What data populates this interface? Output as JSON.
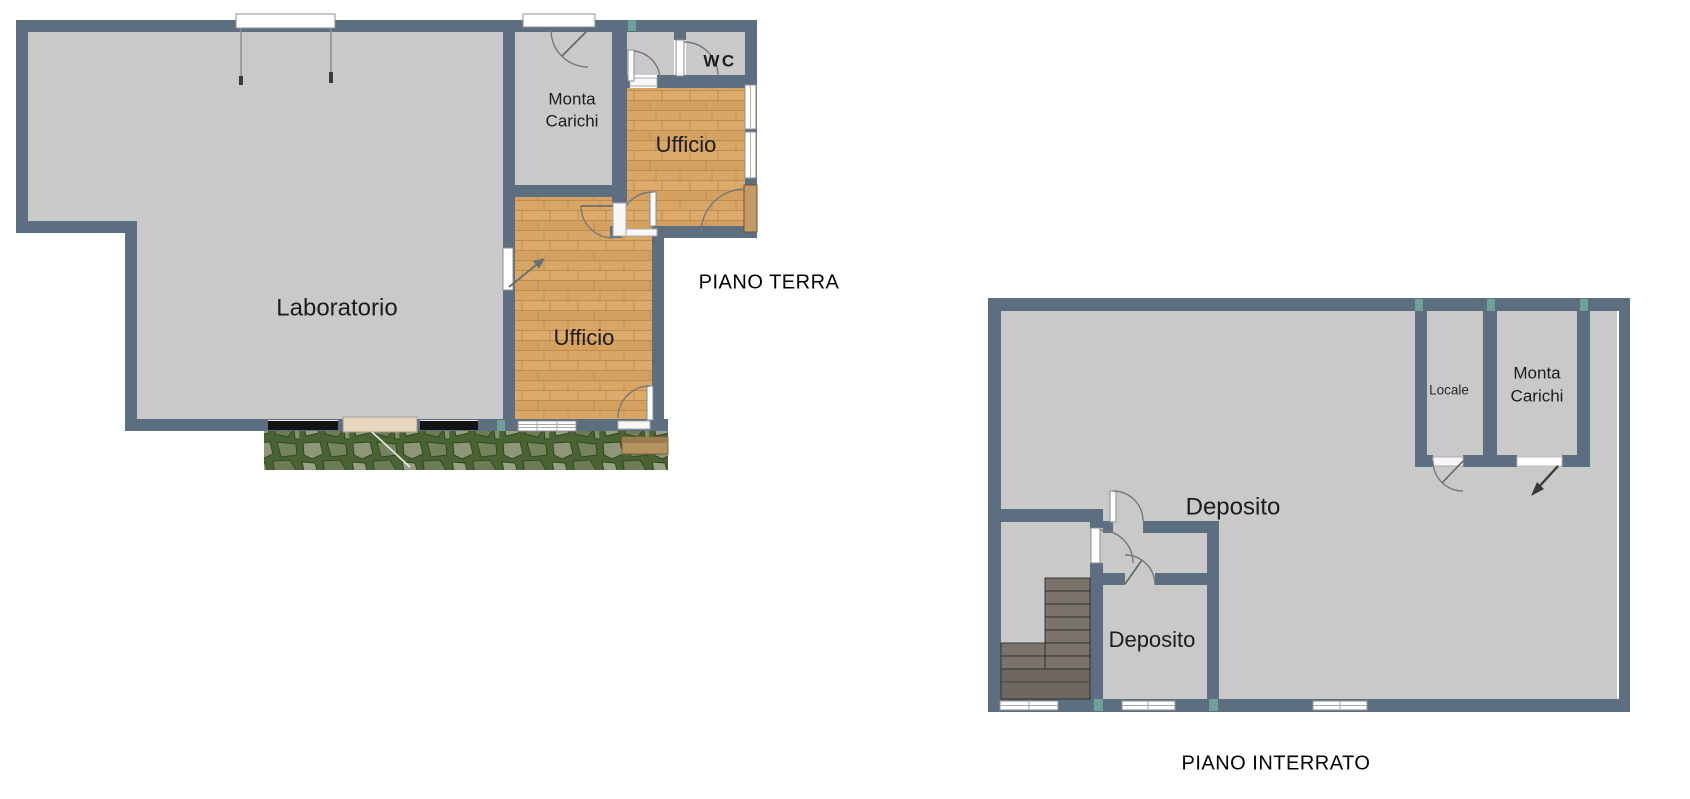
{
  "palette": {
    "wall": "#5c6e7f",
    "floor": "#c9cac8",
    "wood": "#d9a766",
    "terrace_green": "#4a6332",
    "stairs": "#7a736c",
    "window": "#ffffff",
    "door_cream": "#e9d6bf",
    "door_tan": "#c49a66",
    "dark_window": "#141414",
    "tick_green": "#7fd4b0",
    "text": "#1c1c1c",
    "background": "#ffffff"
  },
  "ground_floor": {
    "caption": "PIANO TERRA",
    "rooms": {
      "laboratorio": "Laboratorio",
      "monta_carichi_line1": "Monta",
      "monta_carichi_line2": "Carichi",
      "wc": "WC",
      "ufficio_upper": "Ufficio",
      "ufficio_lower": "Ufficio"
    }
  },
  "basement": {
    "caption": "PIANO INTERRATO",
    "rooms": {
      "locale": "Locale",
      "monta_carichi_line1": "Monta",
      "monta_carichi_line2": "Carichi",
      "deposito_main": "Deposito",
      "deposito_small": "Deposito"
    }
  }
}
